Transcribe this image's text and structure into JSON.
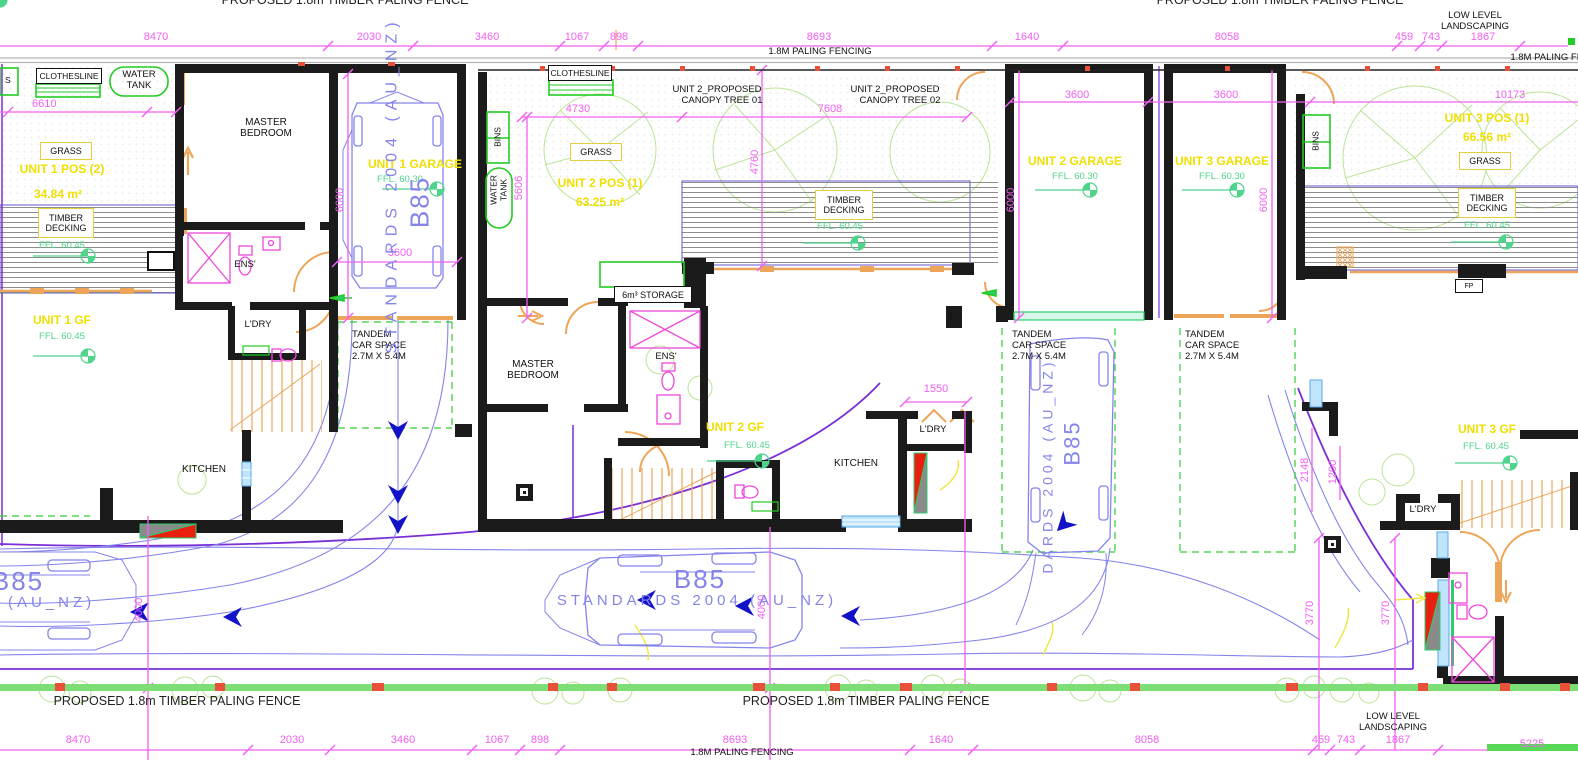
{
  "site": {
    "fence_label": "PROPOSED  1.8m TIMBER PALING FENCE",
    "paling_fencing": "1.8M PALING FENCING",
    "low_level_1": "LOW LEVEL",
    "low_level_2": "LANDSCAPING"
  },
  "dims": {
    "top": {
      "d8470": "8470",
      "d2030": "2030",
      "d3460": "3460",
      "d1067": "1067",
      "d898": "898",
      "d8693": "8693",
      "d1640": "1640",
      "d8058": "8058",
      "d459": "459",
      "d743": "743",
      "d1867": "1867"
    },
    "bottom": {
      "d5225": "5225"
    },
    "inner": {
      "d6610": "6610",
      "d4730": "4730",
      "d7608": "7608",
      "d3600": "3600",
      "d5606": "5606",
      "d4760": "4760",
      "d6000": "6000",
      "d10173": "10173",
      "d1550": "1550",
      "d1200": "1200",
      "d2148": "2148",
      "d3770": "3770",
      "d4000": "4000"
    }
  },
  "units": {
    "unit1": {
      "pos": "UNIT 1 POS (2)",
      "pos_area": "34.84 m²",
      "gf": "UNIT 1 GF",
      "garage": "UNIT 1 GARAGE",
      "ffl_gf": "FFL. 60.45",
      "ffl_garage": "FFL. 60.30",
      "ffl_deck": "FFL. 60.45"
    },
    "unit2": {
      "pos": "UNIT 2 POS (1)",
      "pos_area": "63.25 m²",
      "gf": "UNIT 2 GF",
      "garage": "UNIT 2 GARAGE",
      "ffl_gf": "FFL. 60.45",
      "ffl_garage": "FFL. 60.30",
      "ffl_deck": "FFL. 60.45",
      "storage": "6m³ STORAGE",
      "canopy_line1": "UNIT 2_PROPOSED",
      "canopy1_line2": "CANOPY TREE 01",
      "canopy2_line2": "CANOPY TREE 02"
    },
    "unit3": {
      "pos": "UNIT 3 POS (1)",
      "pos_area": "66.56 m²",
      "gf": "UNIT 3 GF",
      "garage": "UNIT 3 GARAGE",
      "ffl_gf": "FFL. 60.45",
      "ffl_garage": "FFL. 60.30",
      "ffl_deck": "FFL. 60.45"
    }
  },
  "rooms": {
    "master_l1": "MASTER",
    "master_l2": "BEDROOM",
    "ens": "ENS'",
    "ldry": "L'DRY",
    "kitchen": "KITCHEN",
    "grass": "GRASS",
    "timber_l1": "TIMBER",
    "timber_l2": "DECKING",
    "clothesline": "CLOTHESLINE",
    "water_l1": "WATER",
    "water_l2": "TANK",
    "bins": "BINS",
    "bins_partial": "S",
    "fp": "FP",
    "up": "UP"
  },
  "tandem": {
    "l1": "TANDEM",
    "l2": "CAR SPACE",
    "l3": "2.7M X 5.4M"
  },
  "vehicle": {
    "code": "B85",
    "standard": "STANDARDS 2004 (AU_NZ)",
    "standard_cut": "DARDS 2004 (AU_NZ)"
  },
  "colors": {
    "dimension": "#f25ff2",
    "label_yellow": "#f0df00",
    "landscape_green": "#22cc22",
    "ffl_mint": "#4fd48c",
    "vehicle_blue": "#8484ea",
    "arrow_navy": "#1212c8",
    "boundary_purple": "#7a2fd6",
    "door_orange": "#eda55a",
    "fence_red": "#e8503a",
    "window_blue": "#7ec8f7"
  }
}
